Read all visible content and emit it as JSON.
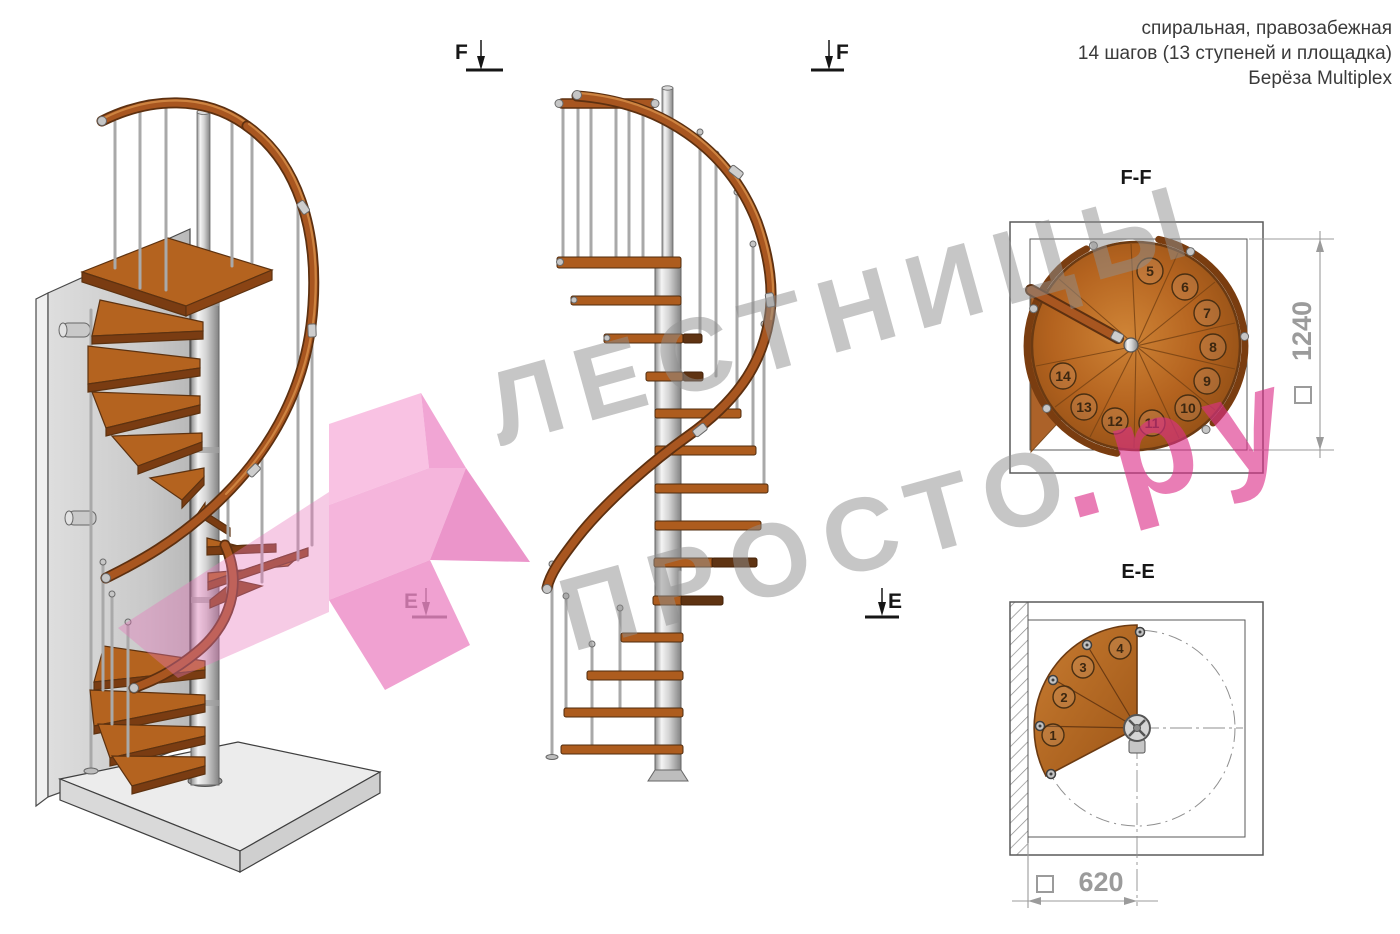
{
  "header": {
    "line1": "спиральная, правозабежная",
    "line2": "14 шагов (13 ступеней и площадка)",
    "line3": "Берёза Multiplex"
  },
  "watermark": {
    "line1": "ЛЕСТНИЦЫ",
    "line2_gray": "ПРОСТО",
    "line2_pink": ".ру"
  },
  "colors": {
    "watermark_gray": "#8f8f8f",
    "watermark_pink": "#dd2f88",
    "logo_pink": "#f2a3d3",
    "wood": "#b4631f",
    "wood_dark": "#6b3a12",
    "metal": "#c9c9c9",
    "dim_gray": "#9b9b9b"
  },
  "views": {
    "ff": {
      "label": "F-F",
      "marker_letter": "F",
      "dimension_value": "1240",
      "steps": [
        "5",
        "6",
        "7",
        "8",
        "9",
        "10",
        "11",
        "12",
        "13",
        "14"
      ]
    },
    "ee": {
      "label": "E-E",
      "marker_letter": "E",
      "dimension_value": "620",
      "steps": [
        "1",
        "2",
        "3",
        "4"
      ]
    }
  }
}
